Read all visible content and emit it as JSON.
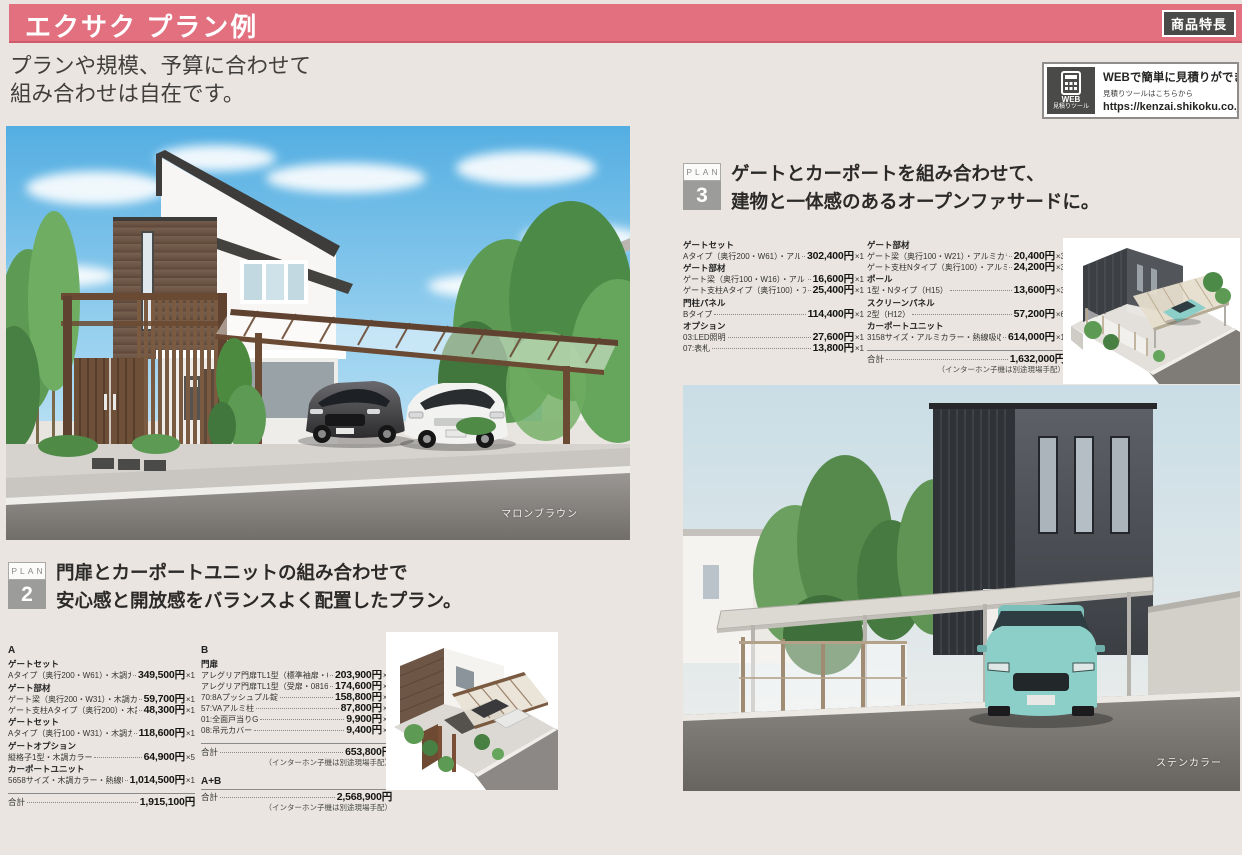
{
  "colors": {
    "header_pink": "#E2707E",
    "badge_dark": "#4A4A48",
    "plan_gray": "#9C9C9A",
    "page_bg": "#EAE5E1",
    "text_dark": "#3B3937"
  },
  "header": {
    "title": "エクサク プラン例",
    "feature_badge": "商品特長",
    "subtitle_line1": "プランや規模、予算に合わせて",
    "subtitle_line2": "組み合わせは自在です。"
  },
  "web_box": {
    "icon": "web-estimate-calculator-icon",
    "icon_label_line1": "WEB",
    "icon_label_line2": "見積りツール",
    "headline": "WEBで簡単に見積りができます。",
    "sub": "見積りツールはこちらから",
    "url": "https://kenzai.shikoku.co.jp/"
  },
  "plan2": {
    "plan_label": "PLAN",
    "number": "2",
    "heading_line1": "門扉とカーポートユニットの組み合わせで",
    "heading_line2": "安心感と開放感をバランスよく配置したプラン。",
    "photo_caption": "マロンブラウン",
    "column_a_rows": [
      {
        "kind": "head",
        "name": "A"
      },
      {
        "kind": "group",
        "name": "ゲートセット"
      },
      {
        "kind": "item",
        "name": "Aタイプ（奥行200・W61）・木調カラー",
        "price": "349,500円",
        "qty": "×1"
      },
      {
        "kind": "group",
        "name": "ゲート部材"
      },
      {
        "kind": "item",
        "name": "ゲート梁（奥行200・W31）・木調カラー",
        "price": "59,700円",
        "qty": "×1"
      },
      {
        "kind": "item",
        "name": "ゲート支柱Aタイプ（奥行200）・木調カラー",
        "price": "48,300円",
        "qty": "×1"
      },
      {
        "kind": "group",
        "name": "ゲートセット"
      },
      {
        "kind": "item",
        "name": "Aタイプ（奥行100・W31）・木調カラー",
        "price": "118,600円",
        "qty": "×1"
      },
      {
        "kind": "group",
        "name": "ゲートオプション"
      },
      {
        "kind": "item",
        "name": "縦格子1型・木調カラー",
        "price": "64,900円",
        "qty": "×5"
      },
      {
        "kind": "group",
        "name": "カーポートユニット"
      },
      {
        "kind": "item",
        "name": "5658サイズ・木調カラー・熱線吸収ポリカ板",
        "price": "1,014,500円",
        "qty": "×1"
      },
      {
        "kind": "total",
        "name": "合計",
        "price": "1,915,100円"
      }
    ],
    "column_b_rows": [
      {
        "kind": "head",
        "name": "B"
      },
      {
        "kind": "group",
        "name": "門扉"
      },
      {
        "kind": "item",
        "name": "アレグリア門扉TL1型（標準袖扉・0816サイズ）",
        "price": "203,900円",
        "qty": "×1"
      },
      {
        "kind": "item",
        "name": "アレグリア門扉TL1型（受扉・0816サイズ）",
        "price": "174,600円",
        "qty": "×1"
      },
      {
        "kind": "item",
        "name": "70:8Aプッシュプル錠",
        "price": "158,800円",
        "qty": "×1"
      },
      {
        "kind": "item",
        "name": "57:VAアルミ柱",
        "price": "87,800円",
        "qty": "×1"
      },
      {
        "kind": "item",
        "name": "01:全面戸当りG",
        "price": "9,900円",
        "qty": "×1"
      },
      {
        "kind": "item",
        "name": "08:吊元カバー",
        "price": "9,400円",
        "qty": "×2"
      },
      {
        "kind": "total",
        "name": "合計",
        "price": "653,800円"
      },
      {
        "kind": "note",
        "name": "（インターホン子機は別途現場手配）"
      },
      {
        "kind": "head2",
        "name": "A+B"
      },
      {
        "kind": "total2",
        "name": "合計",
        "price": "2,568,900円"
      },
      {
        "kind": "note",
        "name": "（インターホン子機は別途現場手配）"
      }
    ]
  },
  "plan3": {
    "plan_label": "PLAN",
    "number": "3",
    "heading_line1": "ゲートとカーポートを組み合わせて、",
    "heading_line2": "建物と一体感のあるオープンファサードに。",
    "photo_caption": "ステンカラー",
    "column_1_rows": [
      {
        "kind": "group",
        "name": "ゲートセット"
      },
      {
        "kind": "item",
        "name": "Aタイプ（奥行200・W61）・アルミカラー",
        "price": "302,400円",
        "qty": "×1"
      },
      {
        "kind": "group",
        "name": "ゲート部材"
      },
      {
        "kind": "item",
        "name": "ゲート梁（奥行100・W16）・アルミカラー",
        "price": "16,600円",
        "qty": "×1"
      },
      {
        "kind": "item",
        "name": "ゲート支柱Aタイプ（奥行100）・アルミカラー",
        "price": "25,400円",
        "qty": "×1"
      },
      {
        "kind": "group",
        "name": "門柱パネル"
      },
      {
        "kind": "item",
        "name": "Bタイプ",
        "price": "114,400円",
        "qty": "×1"
      },
      {
        "kind": "group",
        "name": "オプション"
      },
      {
        "kind": "item",
        "name": "03:LED照明",
        "price": "27,600円",
        "qty": "×1"
      },
      {
        "kind": "item",
        "name": "07:表札",
        "price": "13,800円",
        "qty": "×1"
      }
    ],
    "column_2_rows": [
      {
        "kind": "group",
        "name": "ゲート部材"
      },
      {
        "kind": "item",
        "name": "ゲート梁（奥行100・W21）・アルミカラー",
        "price": "20,400円",
        "qty": "×3"
      },
      {
        "kind": "item",
        "name": "ゲート支柱Nタイプ（奥行100）・アルミカラー",
        "price": "24,200円",
        "qty": "×3"
      },
      {
        "kind": "group",
        "name": "ポール"
      },
      {
        "kind": "item",
        "name": "1型・Nタイプ（H15）",
        "price": "13,600円",
        "qty": "×3"
      },
      {
        "kind": "group",
        "name": "スクリーンパネル"
      },
      {
        "kind": "item",
        "name": "2型（H12）",
        "price": "57,200円",
        "qty": "×6"
      },
      {
        "kind": "group",
        "name": "カーポートユニット"
      },
      {
        "kind": "item",
        "name": "3158サイズ・アルミカラー・熱線吸収ポリカ板",
        "price": "614,000円",
        "qty": "×1"
      },
      {
        "kind": "total",
        "name": "合計",
        "price": "1,632,000円"
      },
      {
        "kind": "note",
        "name": "（インターホン子機は別途現場手配）"
      }
    ]
  }
}
